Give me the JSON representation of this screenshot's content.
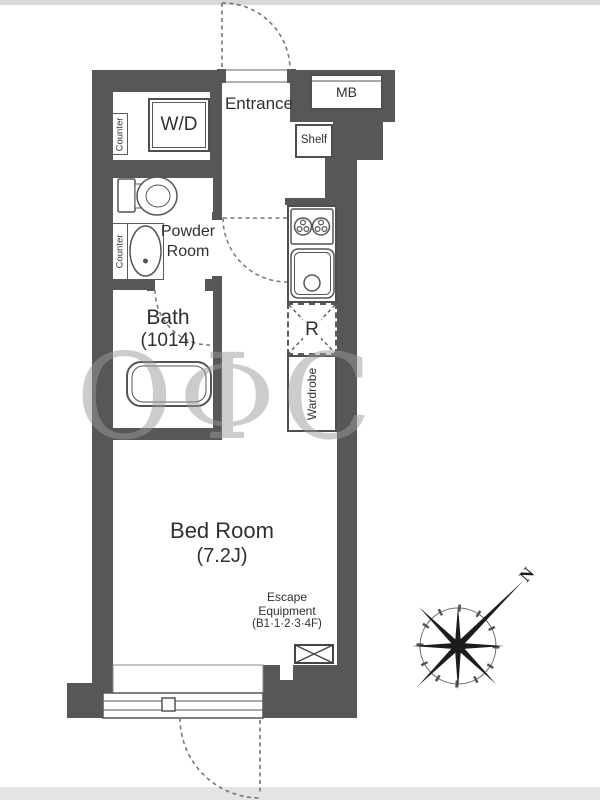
{
  "colors": {
    "wall": "#575757",
    "fixture_line": "#555555",
    "text": "#303030",
    "dashed_line": "#777777",
    "watermark": "#9a9a9a",
    "top_strip": "#d8d8d8",
    "bottom_strip": "#e4e4e2"
  },
  "plan": {
    "entrance": {
      "label": "Entrance"
    },
    "washer_dryer": {
      "label": "W/D"
    },
    "meter_box": {
      "label": "MB"
    },
    "shelf": {
      "label": "Shelf"
    },
    "entry_counter": {
      "label": "Counter"
    },
    "powder_room": {
      "line1": "Powder",
      "line2": "Room",
      "counter_label": "Counter"
    },
    "bath": {
      "label": "Bath",
      "size": "(1014)"
    },
    "kitchen": {
      "refrigerator_label": "R"
    },
    "wardrobe": {
      "label": "Wardrobe"
    },
    "bedroom": {
      "label": "Bed Room",
      "size": "(7.2J)"
    },
    "escape_equipment": {
      "line1": "Escape",
      "line2": "Equipment",
      "line3": "(B1·1·2·3·4F)"
    },
    "compass": {
      "north": "N"
    },
    "watermark": "OΦC"
  }
}
